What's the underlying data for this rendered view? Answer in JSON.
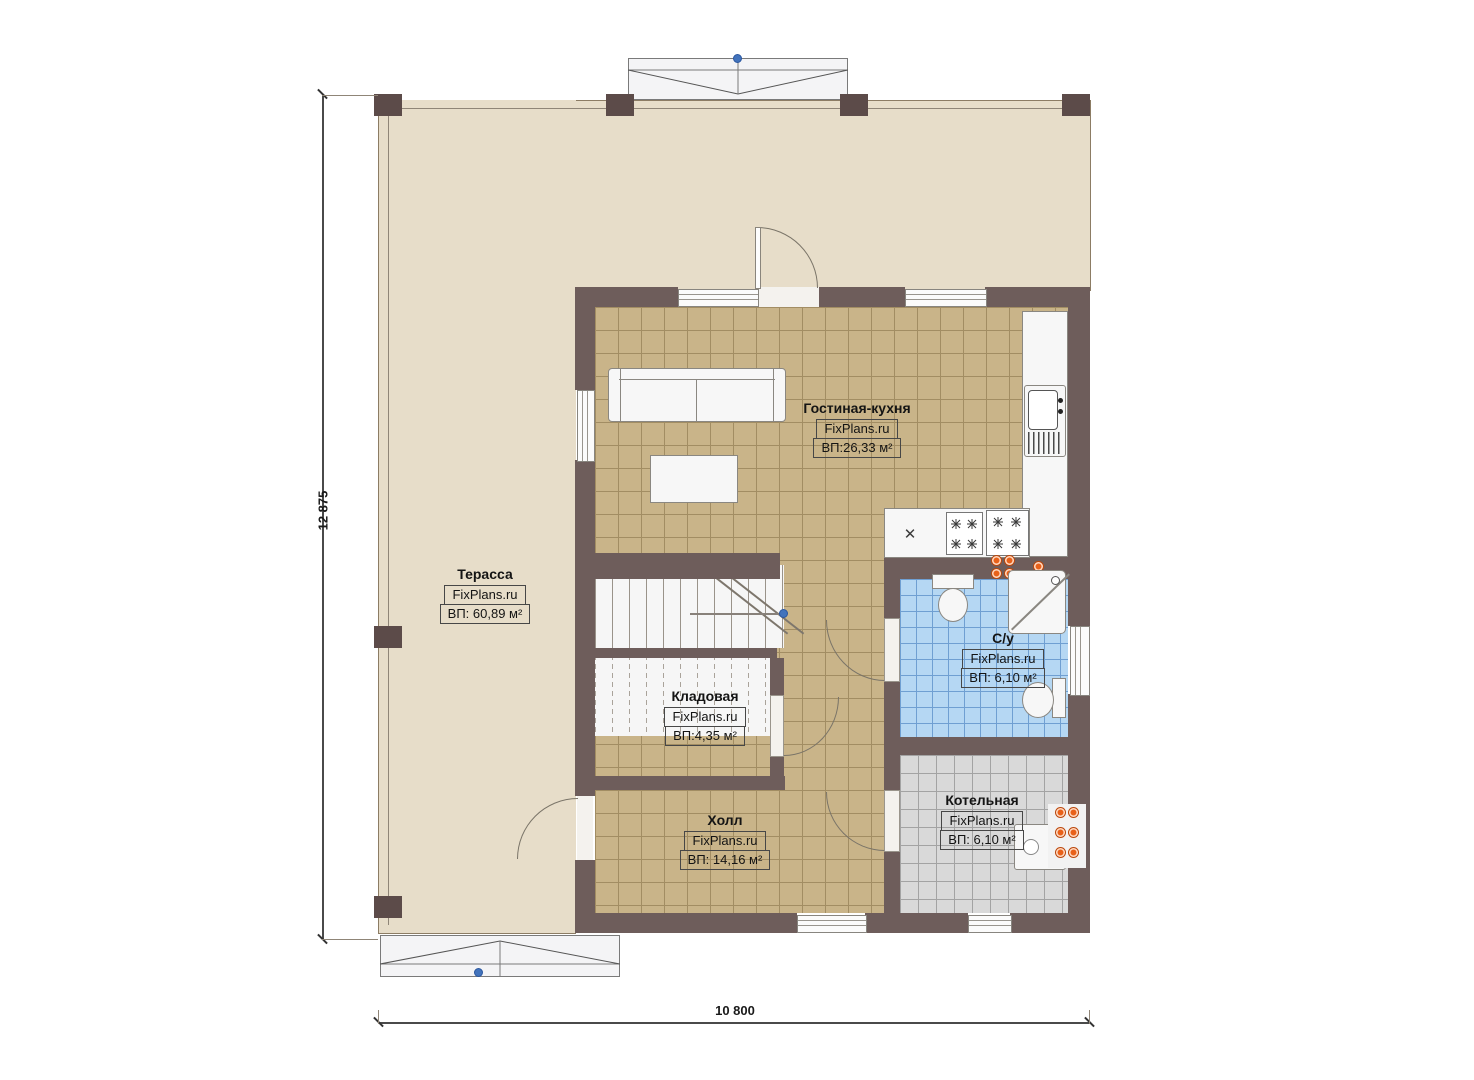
{
  "dimensions": {
    "height_label": "12 875",
    "width_label": "10 800"
  },
  "rooms": {
    "terrace": {
      "name": "Терасса",
      "brand": "FixPlans.ru",
      "area": "ВП: 60,89 м²"
    },
    "living": {
      "name": "Гостиная-кухня",
      "brand": "FixPlans.ru",
      "area": "ВП:26,33 м²"
    },
    "storage": {
      "name": "Кладовая",
      "brand": "FixPlans.ru",
      "area": "ВП:4,35 м²"
    },
    "hall": {
      "name": "Холл",
      "brand": "FixPlans.ru",
      "area": "ВП: 14,16 м²"
    },
    "bath": {
      "name": "С/у",
      "brand": "FixPlans.ru",
      "area": "ВП: 6,10 м²"
    },
    "boiler": {
      "name": "Котельная",
      "brand": "FixPlans.ru",
      "area": "ВП: 6,10 м²"
    }
  },
  "icons": {
    "x_mark": "✕"
  },
  "colors": {
    "wall": "#6e5d5b",
    "terrace_floor": "#e7ddc9",
    "tile_tan": "#c9b489",
    "tile_blue": "#b5d7f3",
    "tile_grey": "#d9d9d9",
    "radiator_orange": "#e8611a",
    "marker_blue": "#4273bc"
  }
}
